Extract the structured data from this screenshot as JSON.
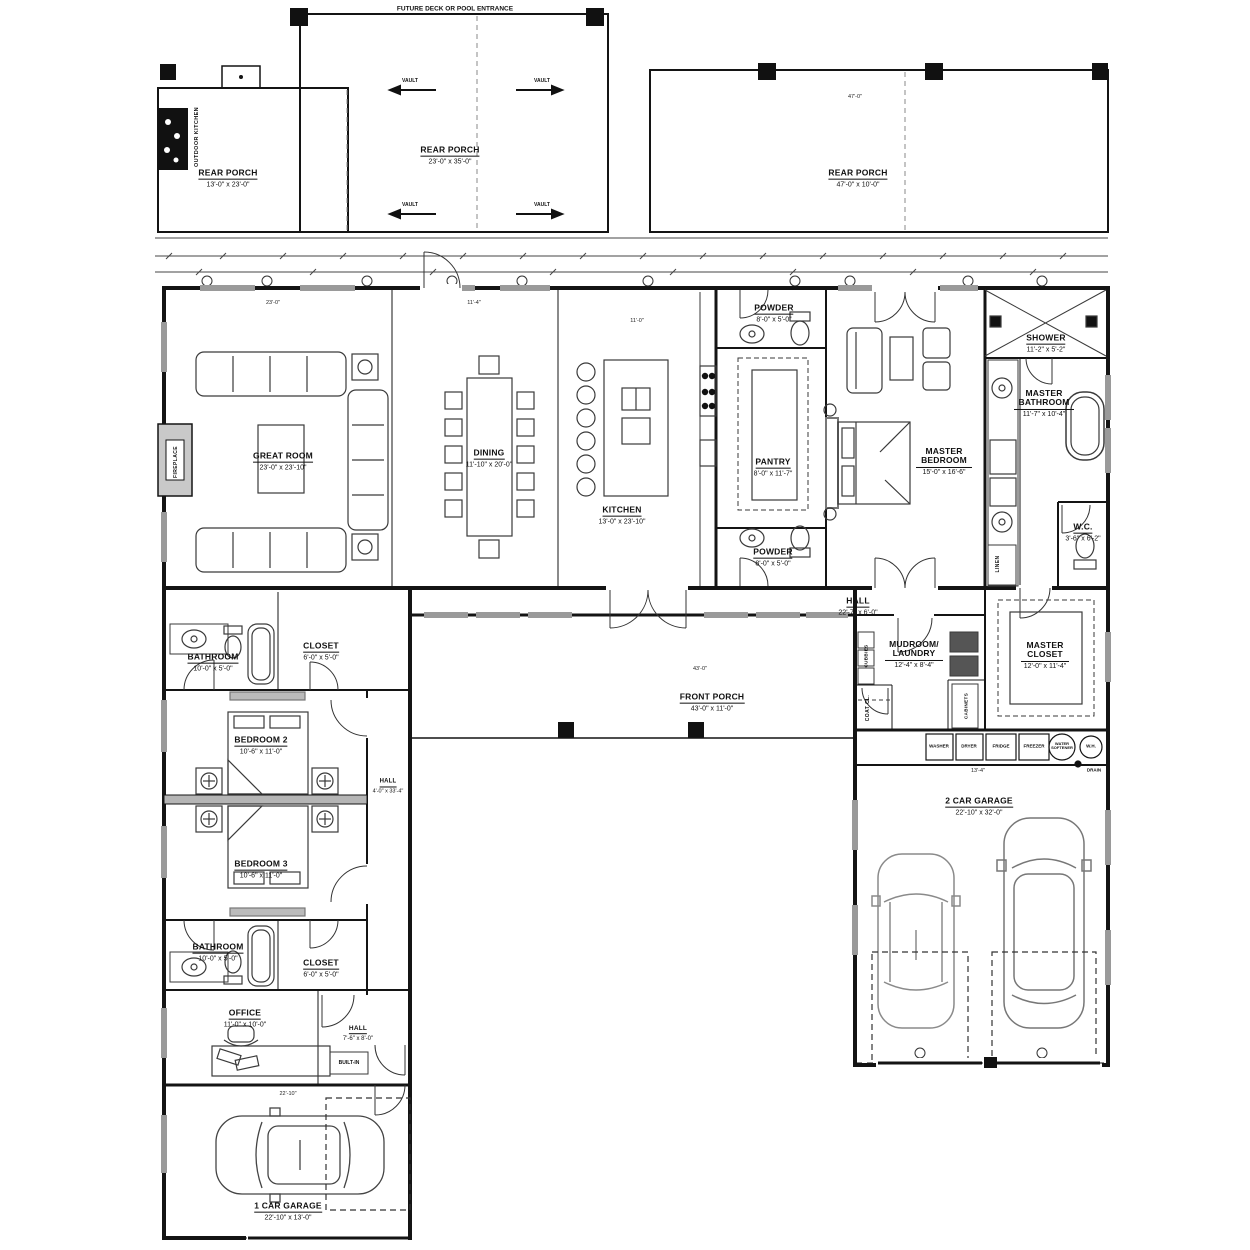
{
  "notes": {
    "top": "FUTURE DECK OR POOL ENTRANCE",
    "vault": "VAULT",
    "drain": "DRAIN",
    "built_in": "BUILT-IN"
  },
  "rooms": {
    "rear_porch_left": {
      "name": "REAR PORCH",
      "dims": "13'-0\" x 23'-0\""
    },
    "rear_porch_center": {
      "name": "REAR PORCH",
      "dims": "23'-0\" x 35'-0\""
    },
    "rear_porch_right": {
      "name": "REAR PORCH",
      "dims": "47'-0\" x 10'-0\""
    },
    "great_room": {
      "name": "GREAT ROOM",
      "dims": "23'-0\" x 23'-10\""
    },
    "dining": {
      "name": "DINING",
      "dims": "11'-10\" x 20'-0\""
    },
    "kitchen": {
      "name": "KITCHEN",
      "dims": "13'-0\" x 23'-10\""
    },
    "pantry": {
      "name": "PANTRY",
      "dims": "8'-0\" x 11'-7\""
    },
    "powder_top": {
      "name": "POWDER",
      "dims": "8'-0\" x 5'-0\""
    },
    "powder_bottom": {
      "name": "POWDER",
      "dims": "8'-0\" x 5'-0\""
    },
    "master_bedroom": {
      "name": "MASTER BEDROOM",
      "dims": "15'-0\" x 16'-6\""
    },
    "shower": {
      "name": "SHOWER",
      "dims": "11'-2\" x 5'-2\""
    },
    "master_bathroom": {
      "name": "MASTER BATHROOM",
      "dims": "11'-7\" x 10'-4\""
    },
    "wc": {
      "name": "W.C.",
      "dims": "3'-6\" x 6'-2\""
    },
    "hall_master": {
      "name": "HALL",
      "dims": "22'-7\" x 6'-0\""
    },
    "master_closet": {
      "name": "MASTER CLOSET",
      "dims": "12'-0\" x 11'-4\""
    },
    "mudroom_laundry": {
      "name": "MUDROOM/ LAUNDRY",
      "dims": "12'-4\" x 8'-4\""
    },
    "front_porch": {
      "name": "FRONT PORCH",
      "dims": "43'-0\" x 11'-0\""
    },
    "bathroom_upper": {
      "name": "BATHROOM",
      "dims": "10'-0\" x 5'-0\""
    },
    "closet_upper": {
      "name": "CLOSET",
      "dims": "6'-0\" x 5'-0\""
    },
    "bedroom2": {
      "name": "BEDROOM 2",
      "dims": "10'-6\" x 11'-0\""
    },
    "bedroom3": {
      "name": "BEDROOM 3",
      "dims": "10'-6\" x 11'-0\""
    },
    "hall_bedrooms": {
      "name": "HALL",
      "dims": "4'-0\" x 33'-4\""
    },
    "bathroom_lower": {
      "name": "BATHROOM",
      "dims": "10'-0\" x 5'-0\""
    },
    "closet_lower": {
      "name": "CLOSET",
      "dims": "6'-0\" x 5'-0\""
    },
    "office": {
      "name": "OFFICE",
      "dims": "11'-0\" x 10'-0\""
    },
    "hall_lower": {
      "name": "HALL",
      "dims": "7'-6\" x 8'-0\""
    },
    "garage2": {
      "name": "2 CAR GARAGE",
      "dims": "22'-10\" x 32'-0\""
    },
    "garage1": {
      "name": "1 CAR GARAGE",
      "dims": "22'-10\" x 13'-0\""
    }
  },
  "vertical_labels": {
    "outdoor_kitchen": "OUTDOOR KITCHEN",
    "fireplace": "FIREPLACE",
    "linen": "LINEN",
    "coat": "COAT CL.",
    "cubbies": "CUBBIES",
    "cabinets": "CABINETS"
  },
  "appliances": {
    "washer": "WASHER",
    "dryer": "DRYER",
    "fridge": "FRIDGE",
    "freezer": "FREEZER",
    "softener": "WATER SOFTENER",
    "wh": "W.H."
  },
  "dims": {
    "d1": "23'-0\"",
    "d2": "11'-4\"",
    "d3": "11'-0\"",
    "d4": "47'-0\"",
    "d5": "43'-0\"",
    "d6": "13'-4\"",
    "d7": "22'-10\""
  },
  "colors": {
    "line": "#141414",
    "window": "#9a9a9a",
    "car": "#8a8a8a"
  }
}
